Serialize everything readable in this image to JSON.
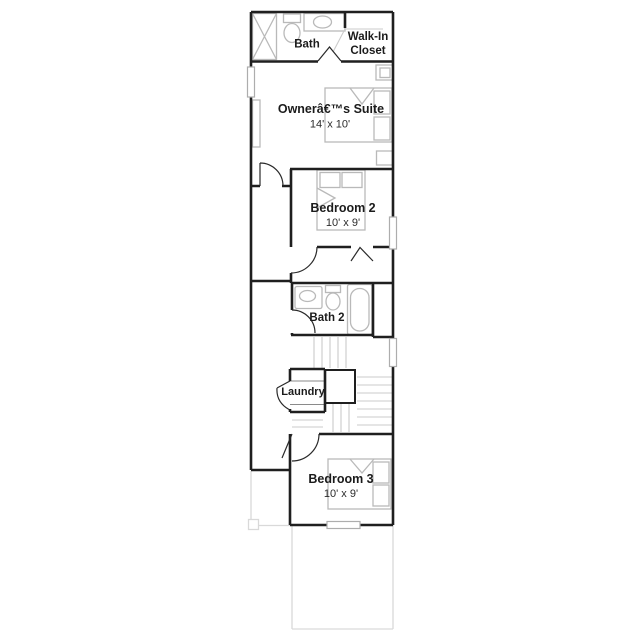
{
  "page": {
    "background_color": "#ffffff",
    "drawing_type": "floor-plan"
  },
  "colors": {
    "wall": "#1f1f1f",
    "fixture": "#b9b9b9",
    "stair": "#cbcbcb",
    "faint_outline": "#d9d9d9",
    "text": "#1b1b1b"
  },
  "rooms": {
    "bath": {
      "label": "Bath"
    },
    "walk_in_closet": {
      "line1": "Walk-In",
      "line2": "Closet"
    },
    "owners_suite": {
      "label": "Ownerâ€™s Suite",
      "dims": "14' x 10'"
    },
    "bedroom2": {
      "label": "Bedroom 2",
      "dims": "10' x 9'"
    },
    "bath2": {
      "label": "Bath 2"
    },
    "laundry": {
      "label": "Laundry"
    },
    "bedroom3": {
      "label": "Bedroom 3",
      "dims": "10' x 9'"
    }
  }
}
